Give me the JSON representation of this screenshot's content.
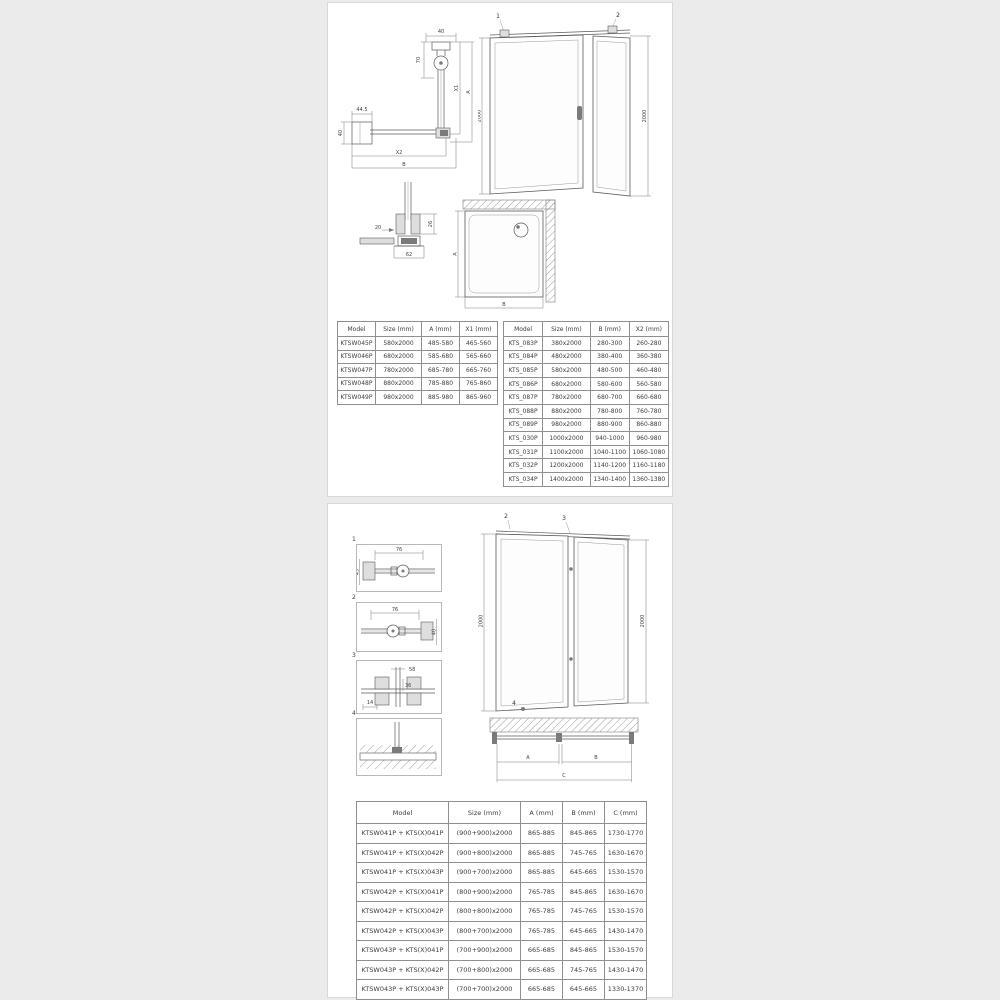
{
  "page": {
    "background": "#ebebeb",
    "card_background": "#ffffff",
    "card_border": "#d7d7d7",
    "line_color": "#5a5a5a"
  },
  "panel_top": {
    "plan_diagram": {
      "dim_top": "40",
      "dim_hinge": "70",
      "dim_x1": "X1",
      "dim_a": "A",
      "dim_left_width": "44.5",
      "dim_left_height": "40",
      "dim_x2": "X2",
      "dim_b": "B"
    },
    "elevation": {
      "callout_left": "1",
      "callout_right": "2",
      "height_left": "2000",
      "height_right": "2000"
    },
    "profile_detail": {
      "dim_gap": "20",
      "dim_height": "26",
      "dim_width": "62"
    },
    "tray_plan": {
      "dim_a": "A",
      "dim_b": "B"
    },
    "door_table": {
      "headers": [
        "Model",
        "Size (mm)",
        "A (mm)",
        "X1 (mm)"
      ],
      "rows": [
        [
          "KTSW045P",
          "580x2000",
          "485-580",
          "465-560"
        ],
        [
          "KTSW046P",
          "680x2000",
          "585-680",
          "565-660"
        ],
        [
          "KTSW047P",
          "780x2000",
          "685-780",
          "665-760"
        ],
        [
          "KTSW048P",
          "880x2000",
          "785-880",
          "765-860"
        ],
        [
          "KTSW049P",
          "980x2000",
          "885-980",
          "865-960"
        ]
      ]
    },
    "wall_table": {
      "headers": [
        "Model",
        "Size (mm)",
        "B (mm)",
        "X2 (mm)"
      ],
      "rows": [
        [
          "KTS_083P",
          "380x2000",
          "280-300",
          "260-280"
        ],
        [
          "KTS_084P",
          "480x2000",
          "380-400",
          "360-380"
        ],
        [
          "KTS_085P",
          "580x2000",
          "480-500",
          "460-480"
        ],
        [
          "KTS_086P",
          "680x2000",
          "580-600",
          "560-580"
        ],
        [
          "KTS_087P",
          "780x2000",
          "680-700",
          "660-680"
        ],
        [
          "KTS_088P",
          "880x2000",
          "780-800",
          "760-780"
        ],
        [
          "KTS_089P",
          "980x2000",
          "880-900",
          "860-880"
        ],
        [
          "KTS_030P",
          "1000x2000",
          "940-1000",
          "960-980"
        ],
        [
          "KTS_031P",
          "1100x2000",
          "1040-1100",
          "1060-1080"
        ],
        [
          "KTS_032P",
          "1200x2000",
          "1140-1200",
          "1160-1180"
        ],
        [
          "KTS_034P",
          "1400x2000",
          "1340-1400",
          "1360-1380"
        ]
      ]
    }
  },
  "panel_bottom": {
    "details": [
      {
        "label": "1",
        "dim_width": "76",
        "dim_height": "43"
      },
      {
        "label": "2",
        "dim_width": "76",
        "dim_height": "40"
      },
      {
        "label": "3",
        "dim_top": "58",
        "dim_mid": "36",
        "dim_bottom": "14"
      },
      {
        "label": "4"
      }
    ],
    "elevation": {
      "callout_door": "2",
      "callout_connector": "3",
      "callout_wall": "1",
      "callout_floor": "4",
      "height_left": "2000",
      "height_right": "2000"
    },
    "plan": {
      "dim_a": "A",
      "dim_b": "B",
      "dim_c": "C"
    },
    "combo_table": {
      "headers": [
        "Model",
        "Size (mm)",
        "A (mm)",
        "B (mm)",
        "C (mm)"
      ],
      "rows": [
        [
          "KTSW041P + KTS(X)041P",
          "(900+900)x2000",
          "865-885",
          "845-865",
          "1730-1770"
        ],
        [
          "KTSW041P + KTS(X)042P",
          "(900+800)x2000",
          "865-885",
          "745-765",
          "1630-1670"
        ],
        [
          "KTSW041P + KTS(X)043P",
          "(900+700)x2000",
          "865-885",
          "645-665",
          "1530-1570"
        ],
        [
          "KTSW042P + KTS(X)041P",
          "(800+900)x2000",
          "765-785",
          "845-865",
          "1630-1670"
        ],
        [
          "KTSW042P + KTS(X)042P",
          "(800+800)x2000",
          "765-785",
          "745-765",
          "1530-1570"
        ],
        [
          "KTSW042P + KTS(X)043P",
          "(800+700)x2000",
          "765-785",
          "645-665",
          "1430-1470"
        ],
        [
          "KTSW043P + KTS(X)041P",
          "(700+900)x2000",
          "665-685",
          "845-865",
          "1530-1570"
        ],
        [
          "KTSW043P + KTS(X)042P",
          "(700+800)x2000",
          "665-685",
          "745-765",
          "1430-1470"
        ],
        [
          "KTSW043P + KTS(X)043P",
          "(700+700)x2000",
          "665-685",
          "645-665",
          "1330-1370"
        ]
      ]
    }
  }
}
